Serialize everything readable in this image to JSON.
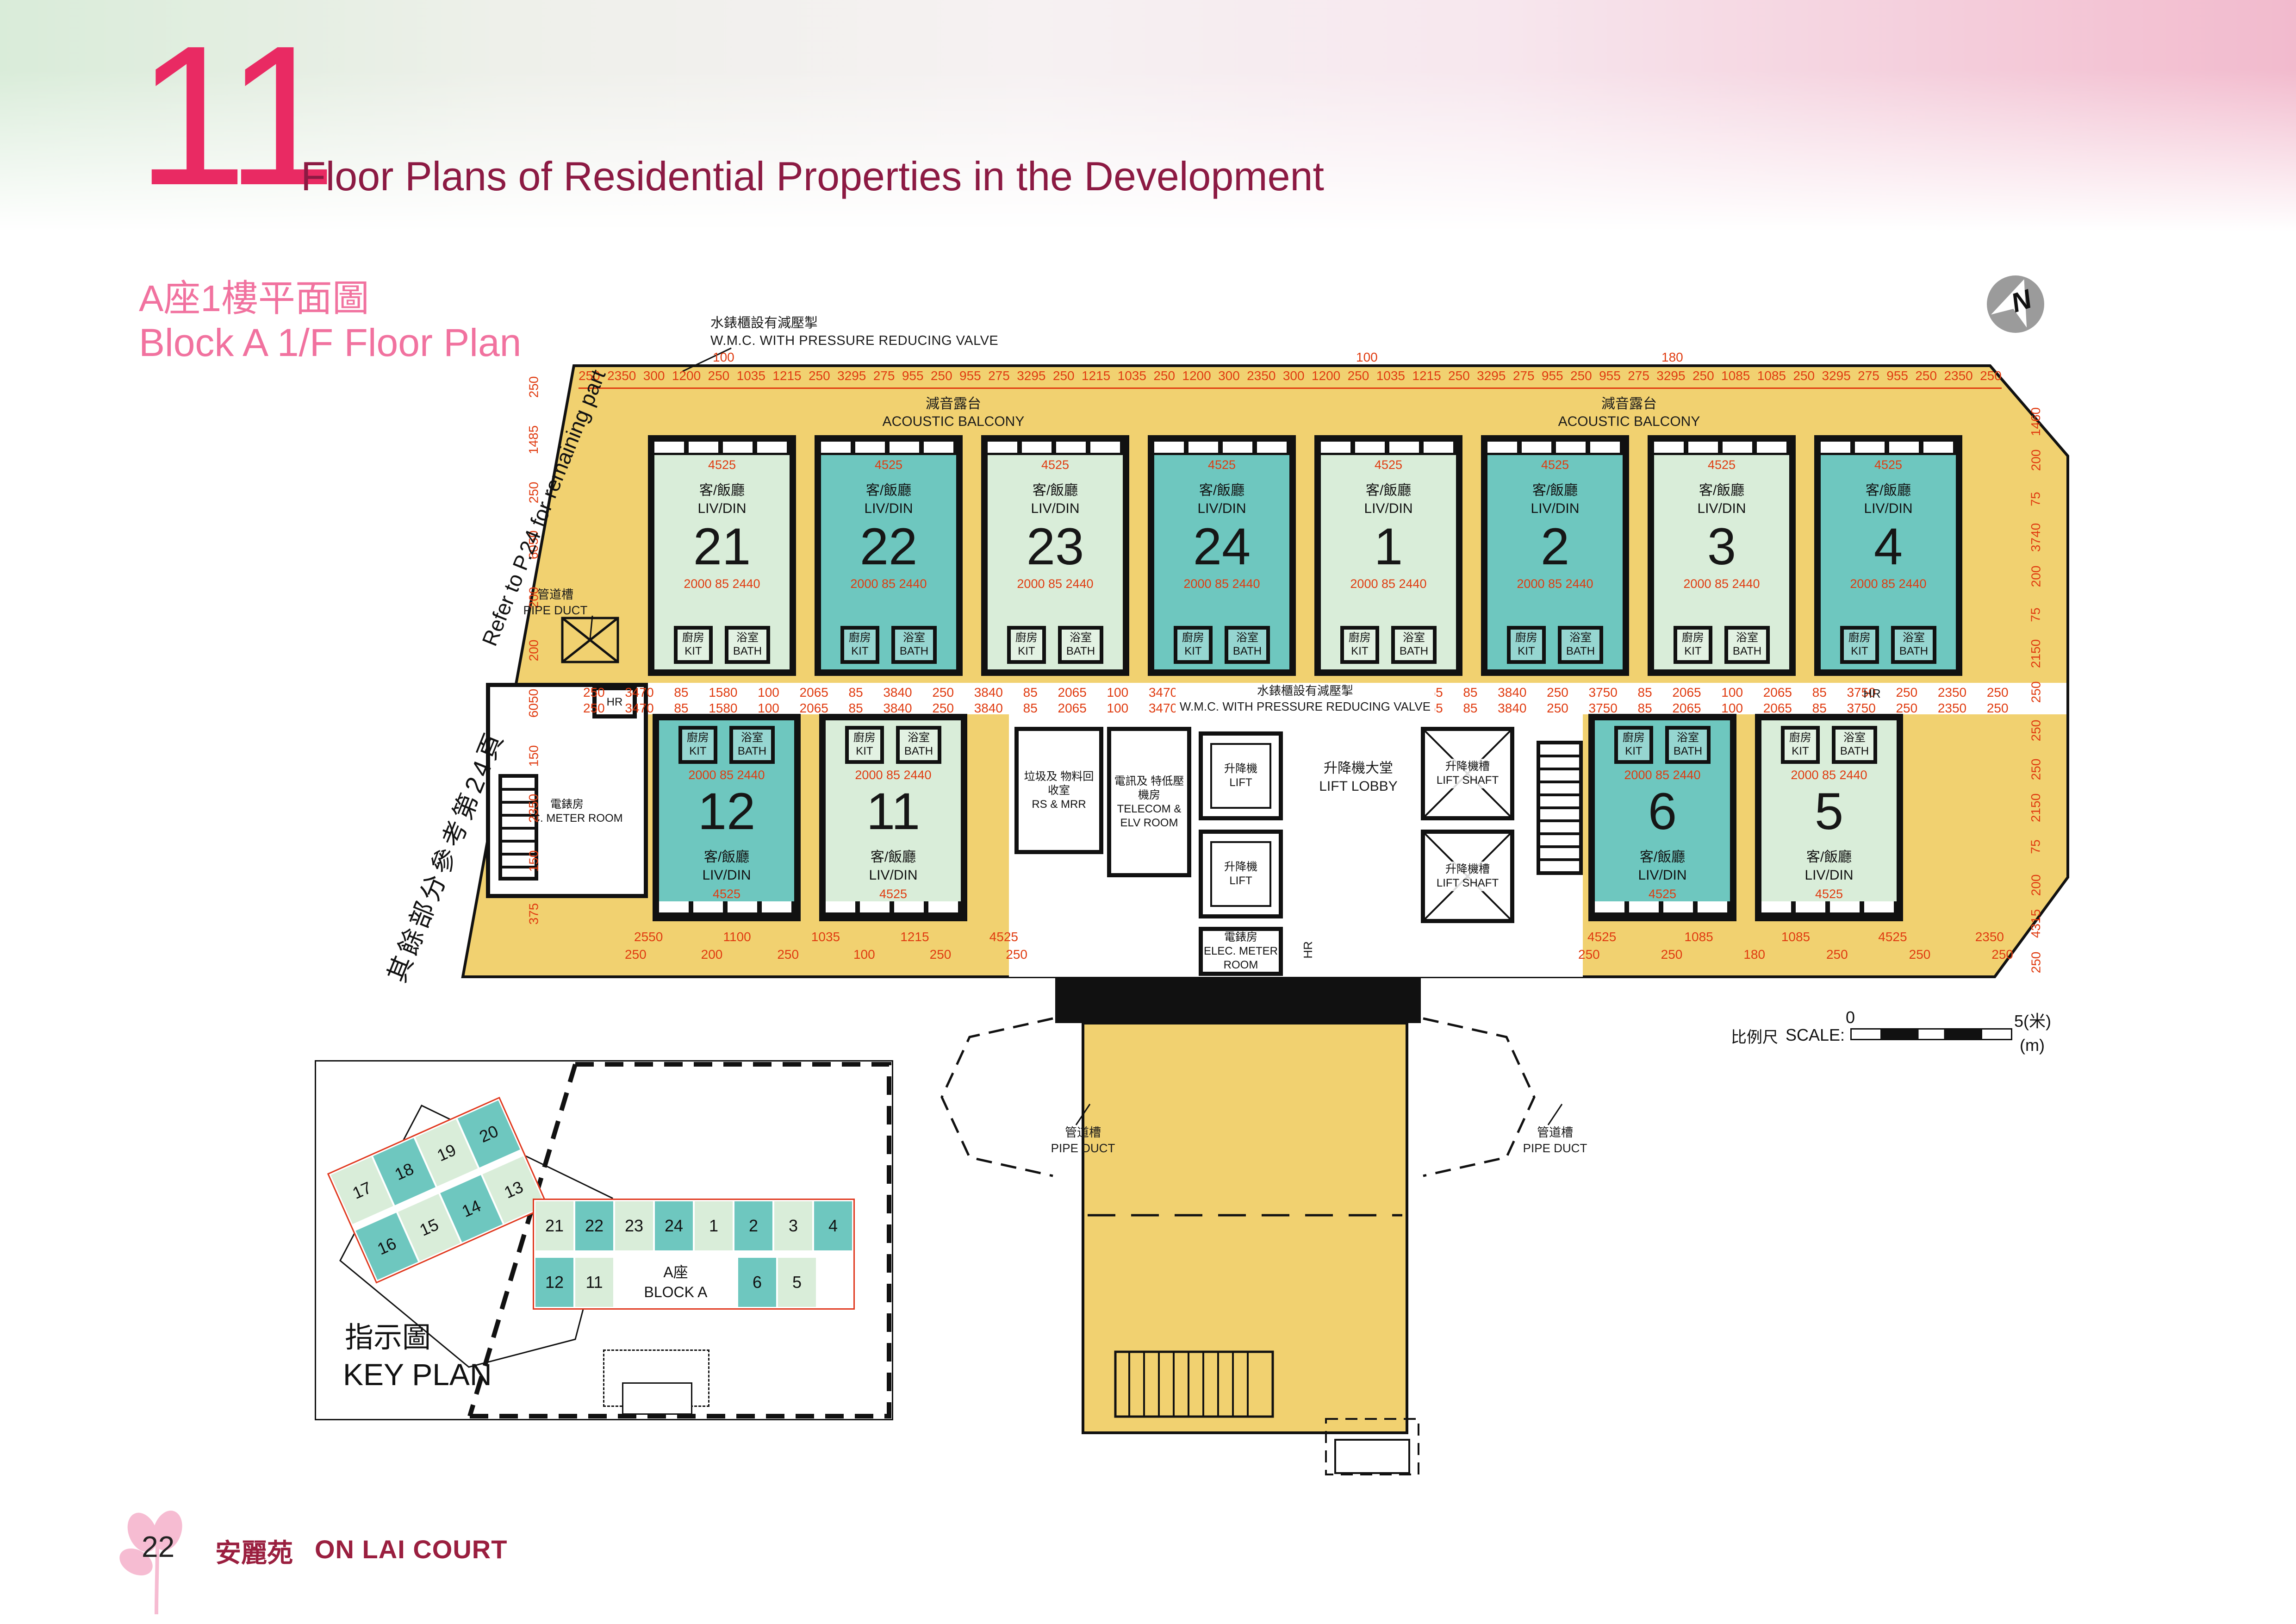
{
  "page": {
    "number_badge": "11",
    "header_title": "Floor Plans of Residential Properties in the Development",
    "plan_title_zh": "A座1樓平面圖",
    "plan_title_en": "Block A 1/F Floor Plan",
    "footer_page": "22",
    "footer_name_zh": "安麗苑",
    "footer_name_en": "ON LAI COURT"
  },
  "colors": {
    "accent_pink": "#e92a63",
    "header_maroon": "#8c1a43",
    "plan_title_pink": "#f1729f",
    "dimension_red": "#e03b10",
    "plan_yellow": "#f1d170",
    "unit_teal": "#6ec7bf",
    "unit_green": "#d9edd9",
    "wall_black": "#111111",
    "footer_maroon": "#9a1f3f",
    "north_grey": "#9b9b9b"
  },
  "annotations": {
    "wmc_zh": "水錶櫃設有減壓掣",
    "wmc_en": "W.M.C. WITH PRESSURE REDUCING VALVE",
    "refer_en": "Refer to P.24 for remaining part",
    "refer_zh": "其餘部分參考第24頁",
    "acoustic_zh": "減音露台",
    "acoustic_en": "ACOUSTIC BALCONY",
    "pipe_zh": "管道槽",
    "pipe_en": "PIPE DUCT",
    "north": "N"
  },
  "rooms": {
    "livdin_zh": "客/飯廳",
    "livdin_en": "LIV/DIN",
    "kit_zh": "廚房",
    "kit_en": "KIT",
    "bath_zh": "浴室",
    "bath_en": "BATH",
    "lift_zh": "升降機",
    "lift_en": "LIFT",
    "lift_lobby_zh": "升降機大堂",
    "lift_lobby_en": "LIFT LOBBY",
    "lift_shaft_zh": "升降機槽",
    "lift_shaft_en": "LIFT SHAFT",
    "telecom_zh": "電訊及 特低壓機房",
    "telecom_en": "TELECOM & ELV ROOM",
    "rsmrr_zh": "垃圾及 物料回收室",
    "rsmrr_en": "RS & MRR",
    "elec_zh": "電錶房",
    "elec_en": "ELEC. METER ROOM",
    "hr": "HR"
  },
  "unit_dims": {
    "top_width": "4525",
    "inner_split": "2000  85  2440",
    "depth": "6215"
  },
  "units": {
    "top": [
      {
        "no": "21",
        "s": "g"
      },
      {
        "no": "22",
        "s": "t"
      },
      {
        "no": "23",
        "s": "g"
      },
      {
        "no": "24",
        "s": "t"
      },
      {
        "no": "1",
        "s": "g"
      },
      {
        "no": "2",
        "s": "t"
      },
      {
        "no": "3",
        "s": "g"
      },
      {
        "no": "4",
        "s": "t"
      }
    ],
    "bottom_left": [
      {
        "no": "12",
        "s": "t"
      },
      {
        "no": "11",
        "s": "g"
      }
    ],
    "bottom_right": [
      {
        "no": "6",
        "s": "t"
      },
      {
        "no": "5",
        "s": "g"
      }
    ]
  },
  "dims": {
    "top_above": [
      "100",
      "100",
      "180"
    ],
    "top": [
      "250",
      "2350",
      "300",
      "1200",
      "250",
      "1035",
      "1215",
      "250",
      "3295",
      "275",
      "955",
      "250",
      "955",
      "275",
      "3295",
      "250",
      "1215",
      "1035",
      "250",
      "1200",
      "300",
      "2350",
      "300",
      "1200",
      "250",
      "1035",
      "1215",
      "250",
      "3295",
      "275",
      "955",
      "250",
      "955",
      "275",
      "3295",
      "250",
      "1085",
      "1085",
      "250",
      "3295",
      "275",
      "955",
      "250",
      "2350",
      "250"
    ],
    "mid": [
      "250",
      "3470",
      "85",
      "1580",
      "100",
      "2065",
      "85",
      "3840",
      "250",
      "3840",
      "85",
      "2065",
      "100",
      "3470",
      "300",
      "3470",
      "85",
      "1580",
      "100",
      "2065",
      "85",
      "3840",
      "250",
      "3750",
      "85",
      "2065",
      "100",
      "2065",
      "85",
      "3750",
      "250",
      "2350",
      "250"
    ],
    "bottom_left_a": [
      "2550",
      "1100",
      "1035",
      "1215",
      "4525"
    ],
    "bottom_left_b": [
      "250",
      "200",
      "250",
      "100",
      "250",
      "250"
    ],
    "bottom_right_a": [
      "4525",
      "1085",
      "1085",
      "4525",
      "2350"
    ],
    "bottom_right_b": [
      "250",
      "250",
      "180",
      "250",
      "250",
      "250"
    ],
    "left_edge": [
      "250",
      "1485",
      "250",
      "6050",
      "200",
      "200",
      "6050",
      "150",
      "2350",
      "150",
      "375"
    ],
    "right_edge": [
      "1460",
      "200",
      "75",
      "3740",
      "200",
      "75",
      "2150",
      "250",
      "250",
      "250",
      "2150",
      "75",
      "200",
      "4315",
      "250"
    ]
  },
  "scale_bar": {
    "label_zh": "比例尺",
    "label_en": "SCALE:",
    "zero": "0",
    "five": "5(米)",
    "meters": "(m)"
  },
  "key_plan": {
    "title_zh": "指示圖",
    "title_en": "KEY PLAN",
    "block_zh": "A座",
    "block_en": "BLOCK A",
    "left_top": [
      {
        "no": "17",
        "s": "g"
      },
      {
        "no": "18",
        "s": "t"
      },
      {
        "no": "19",
        "s": "g"
      },
      {
        "no": "20",
        "s": "t"
      }
    ],
    "left_bottom": [
      {
        "no": "16",
        "s": "t"
      },
      {
        "no": "15",
        "s": "g"
      },
      {
        "no": "14",
        "s": "t"
      },
      {
        "no": "13",
        "s": "g"
      }
    ],
    "right_top": [
      {
        "no": "21",
        "s": "g"
      },
      {
        "no": "22",
        "s": "t"
      },
      {
        "no": "23",
        "s": "g"
      },
      {
        "no": "24",
        "s": "t"
      },
      {
        "no": "1",
        "s": "g"
      },
      {
        "no": "2",
        "s": "t"
      },
      {
        "no": "3",
        "s": "g"
      },
      {
        "no": "4",
        "s": "t"
      }
    ],
    "right_bottom_left": [
      {
        "no": "12",
        "s": "t"
      },
      {
        "no": "11",
        "s": "g"
      }
    ],
    "right_bottom_right": [
      {
        "no": "6",
        "s": "t"
      },
      {
        "no": "5",
        "s": "g"
      }
    ]
  }
}
